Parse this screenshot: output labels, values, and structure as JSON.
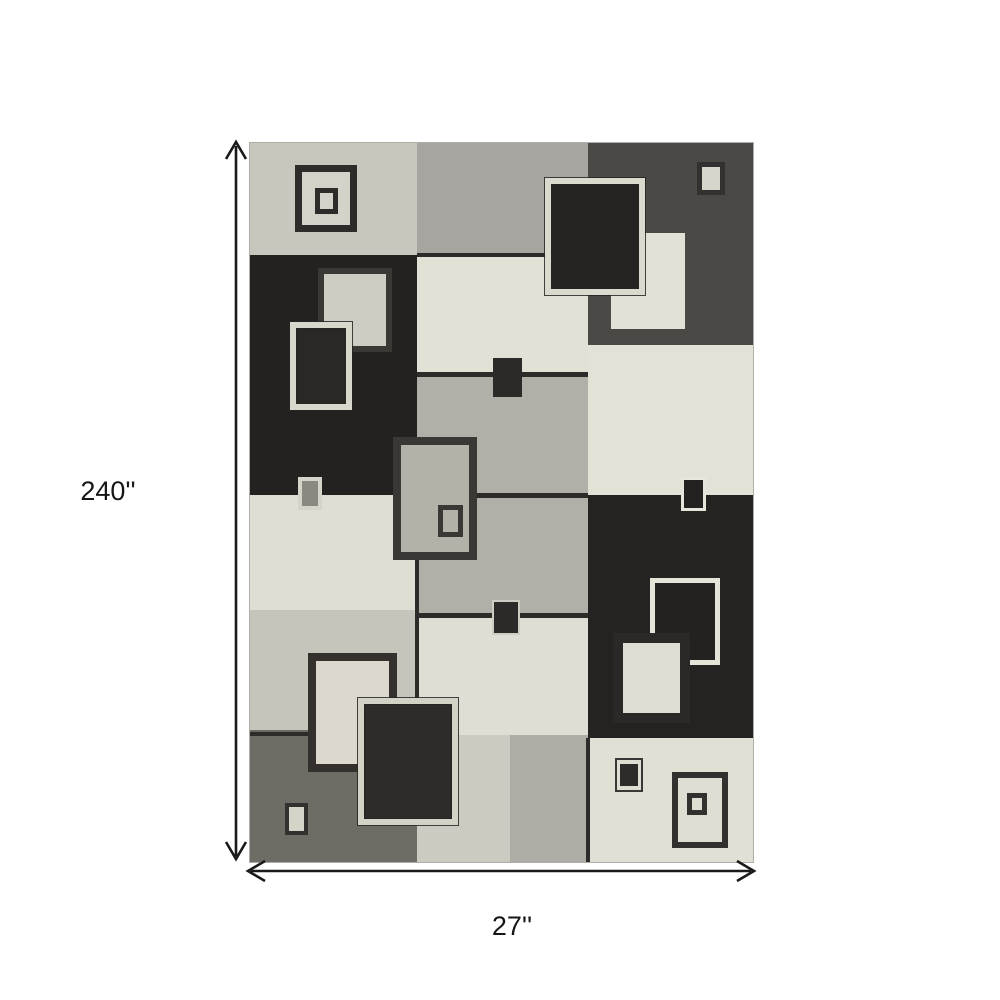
{
  "diagram": {
    "height_label": "240''",
    "width_label": "27''",
    "arrow_color": "#1a1a1a"
  },
  "rug": {
    "palette": {
      "cream": "#e3e0d6",
      "greige": "#c9c6bd",
      "mid_gray": "#a8a5a0",
      "black": "#242221",
      "dark_streak_gray": "#4b4845",
      "bottom_streak_gray": "#6f6c66",
      "seam_line": "#2e2c2a"
    },
    "panels": [
      {
        "name": "panel-greige-top-left",
        "x": 0,
        "y": 0,
        "w": 167,
        "h": 112,
        "color": "#c9c6bd",
        "tex": "light"
      },
      {
        "name": "panel-midgray-top",
        "x": 167,
        "y": 0,
        "w": 171,
        "h": 112,
        "color": "#a8a5a0",
        "tex": "light"
      },
      {
        "name": "panel-darkstreak-top-right",
        "x": 338,
        "y": 0,
        "w": 165,
        "h": 202,
        "color": "#4b4845",
        "tex": "dark"
      },
      {
        "name": "panel-black-left",
        "x": 0,
        "y": 112,
        "w": 167,
        "h": 240,
        "color": "#242221",
        "tex": "dark"
      },
      {
        "name": "panel-cream-mid-upper",
        "x": 167,
        "y": 112,
        "w": 171,
        "h": 119,
        "color": "#e3e0d6",
        "tex": "light"
      },
      {
        "name": "panel-gray-mid",
        "x": 167,
        "y": 231,
        "w": 171,
        "h": 241,
        "color": "#b2afa8",
        "tex": "light"
      },
      {
        "name": "panel-cream-right",
        "x": 338,
        "y": 202,
        "w": 165,
        "h": 150,
        "color": "#e4e1d7",
        "tex": "light"
      },
      {
        "name": "panel-cream-left",
        "x": 0,
        "y": 352,
        "w": 167,
        "h": 115,
        "color": "#e0ddd3",
        "tex": "light"
      },
      {
        "name": "panel-lightgray-left",
        "x": 0,
        "y": 467,
        "w": 167,
        "h": 120,
        "color": "#c7c4bb",
        "tex": "light"
      },
      {
        "name": "panel-black-right",
        "x": 338,
        "y": 352,
        "w": 165,
        "h": 243,
        "color": "#242321",
        "tex": "dark"
      },
      {
        "name": "panel-cream-mid-lower",
        "x": 167,
        "y": 472,
        "w": 171,
        "h": 120,
        "color": "#e0ddd4",
        "tex": "light"
      },
      {
        "name": "panel-streakgray-bottom-left",
        "x": 0,
        "y": 587,
        "w": 167,
        "h": 132,
        "color": "#6f6c66",
        "tex": "dark"
      },
      {
        "name": "panel-light-bottom-center",
        "x": 167,
        "y": 592,
        "w": 93,
        "h": 127,
        "color": "#cdcac1",
        "tex": "light"
      },
      {
        "name": "panel-gray-bottom-center",
        "x": 260,
        "y": 592,
        "w": 78,
        "h": 127,
        "color": "#b0ada6",
        "tex": "light"
      },
      {
        "name": "panel-cream-bottom-right",
        "x": 338,
        "y": 595,
        "w": 165,
        "h": 124,
        "color": "#e2dfd5",
        "tex": "light"
      }
    ],
    "seams": [
      {
        "x": 167,
        "y": 110,
        "w": 171,
        "h": 4
      },
      {
        "x": 167,
        "y": 229,
        "w": 171,
        "h": 5
      },
      {
        "x": 167,
        "y": 350,
        "w": 171,
        "h": 5
      },
      {
        "x": 167,
        "y": 470,
        "w": 171,
        "h": 5
      },
      {
        "x": 165,
        "y": 352,
        "w": 4,
        "h": 240
      },
      {
        "x": 336,
        "y": 595,
        "w": 4,
        "h": 124
      },
      {
        "x": 0,
        "y": 589,
        "w": 167,
        "h": 4
      }
    ],
    "squares": [
      {
        "name": "gray-bordered-cream-square",
        "x": 353,
        "y": 82,
        "w": 90,
        "h": 112,
        "bw": 8,
        "bc": "#4b4845",
        "fill": "#e3e0d6",
        "tex": "light"
      },
      {
        "name": "cream-bordered-dark-square",
        "x": 295,
        "y": 35,
        "w": 100,
        "h": 117,
        "bw": 6,
        "bc": "#dcd9cf",
        "fill": "#262423",
        "outline": 1,
        "tex": "dark"
      },
      {
        "name": "outlined-square-outer",
        "x": 45,
        "y": 22,
        "w": 62,
        "h": 67,
        "bw": 7,
        "bc": "#2e2c2a",
        "fill": "#d5d2c9"
      },
      {
        "name": "outlined-square-inner",
        "x": 65,
        "y": 45,
        "w": 23,
        "h": 26,
        "bw": 5,
        "bc": "#2e2c2a",
        "fill": "#d5d2c9"
      },
      {
        "name": "small-outlined-rect",
        "x": 447,
        "y": 19,
        "w": 28,
        "h": 33,
        "bw": 5,
        "bc": "#33312f",
        "fill": "#d8d5cb"
      },
      {
        "name": "dark-bordered-light-square",
        "x": 68,
        "y": 125,
        "w": 74,
        "h": 84,
        "bw": 6,
        "bc": "#3a3835",
        "fill": "#cfccc3",
        "tex": "light"
      },
      {
        "name": "cream-bordered-dark-square",
        "x": 40,
        "y": 179,
        "w": 62,
        "h": 88,
        "bw": 6,
        "bc": "#d9d6cc",
        "fill": "#2a2827",
        "outline": 1,
        "tex": "dark"
      },
      {
        "name": "small-dark-square",
        "x": 243,
        "y": 215,
        "w": 29,
        "h": 39,
        "bw": 0,
        "bc": "#2c2a28",
        "fill": "#2c2a28"
      },
      {
        "name": "cream-bordered-small-rect",
        "x": 48,
        "y": 334,
        "w": 24,
        "h": 33,
        "bw": 4,
        "bc": "#d6d3c9",
        "fill": "#8b8881"
      },
      {
        "name": "gray-square-outer",
        "x": 143,
        "y": 294,
        "w": 84,
        "h": 123,
        "bw": 8,
        "bc": "#3a3835",
        "fill": "#b4b1a9",
        "tex": "light"
      },
      {
        "name": "gray-square-inner",
        "x": 188,
        "y": 362,
        "w": 25,
        "h": 32,
        "bw": 5,
        "bc": "#3a3835",
        "fill": "#b4b1a9"
      },
      {
        "name": "light-bordered-dark-square",
        "x": 431,
        "y": 334,
        "w": 25,
        "h": 34,
        "bw": 3,
        "bc": "#e8e5db",
        "fill": "#242220"
      },
      {
        "name": "small-dark-square",
        "x": 242,
        "y": 457,
        "w": 28,
        "h": 35,
        "bw": 2,
        "bc": "#cfccc4",
        "fill": "#2c2a28"
      },
      {
        "name": "light-bordered-dark-square",
        "x": 400,
        "y": 435,
        "w": 70,
        "h": 87,
        "bw": 5,
        "bc": "#e6e3d9",
        "fill": "#242220",
        "tex": "dark"
      },
      {
        "name": "dark-framed-cream-square",
        "x": 363,
        "y": 490,
        "w": 77,
        "h": 90,
        "bw": 10,
        "bc": "#2b2927",
        "fill": "#e0ddd3"
      },
      {
        "name": "dark-bordered-cream-square",
        "x": 58,
        "y": 510,
        "w": 89,
        "h": 119,
        "bw": 8,
        "bc": "#33302e",
        "fill": "#dcd8ce",
        "tex": "light"
      },
      {
        "name": "cream-bordered-dark-square",
        "x": 108,
        "y": 555,
        "w": 100,
        "h": 127,
        "bw": 6,
        "bc": "#d4d1c7",
        "fill": "#2e2c2a",
        "outline": 1,
        "tex": "dark"
      },
      {
        "name": "small-outlined-light-square",
        "x": 35,
        "y": 660,
        "w": 23,
        "h": 32,
        "bw": 4,
        "bc": "#33312f",
        "fill": "#d6d3c9"
      },
      {
        "name": "small-dark-square-ring",
        "x": 365,
        "y": 615,
        "w": 28,
        "h": 34,
        "bw": 2,
        "bc": "#3a3836",
        "fill": "#e0ddd3"
      },
      {
        "name": "small-dark-square-core",
        "x": 370,
        "y": 621,
        "w": 18,
        "h": 22,
        "bw": 0,
        "bc": "#2e2c2a",
        "fill": "#2e2c2a"
      },
      {
        "name": "outlined-square-outer",
        "x": 422,
        "y": 629,
        "w": 56,
        "h": 76,
        "bw": 6,
        "bc": "#33312f",
        "fill": "#e0ddd3"
      },
      {
        "name": "outlined-square-inner",
        "x": 437,
        "y": 650,
        "w": 20,
        "h": 22,
        "bw": 5,
        "bc": "#33312f",
        "fill": "#e0ddd3"
      }
    ]
  }
}
